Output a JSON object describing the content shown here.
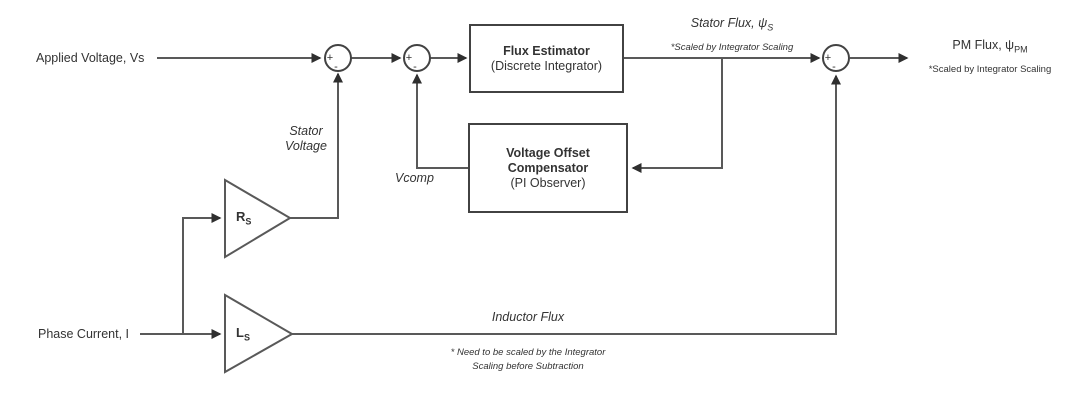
{
  "diagram": {
    "labels": {
      "applied_voltage": "Applied Voltage, Vs",
      "phase_current": "Phase Current, I",
      "stator_voltage_line1": "Stator",
      "stator_voltage_line2": "Voltage",
      "vcomp": "Vcomp",
      "inductor_flux": "Inductor Flux"
    },
    "blocks": {
      "flux_estimator": {
        "title": "Flux Estimator",
        "subtitle": "(Discrete Integrator)"
      },
      "voltage_offset_compensator": {
        "title_line1": "Voltage Offset",
        "title_line2": "Compensator",
        "subtitle": "(PI Observer)"
      },
      "rs_gain": {
        "symbol": "R",
        "subscript": "S"
      },
      "ls_gain": {
        "symbol": "L",
        "subscript": "S"
      }
    },
    "outputs": {
      "stator_flux": {
        "label": "Stator Flux, ψ",
        "subscript": "S",
        "note": "*Scaled by Integrator Scaling"
      },
      "pm_flux": {
        "label": "PM Flux, ψ",
        "subscript": "PM",
        "note": "*Scaled by Integrator Scaling"
      }
    },
    "junction_signs": {
      "plus": "+",
      "minus": "-"
    },
    "footnote": {
      "line1": "* Need to be scaled by the Integrator",
      "line2": "Scaling before Subtraction"
    },
    "colors": {
      "line": "#595959",
      "border": "#424242",
      "text": "#333333",
      "background": "#ffffff"
    }
  }
}
